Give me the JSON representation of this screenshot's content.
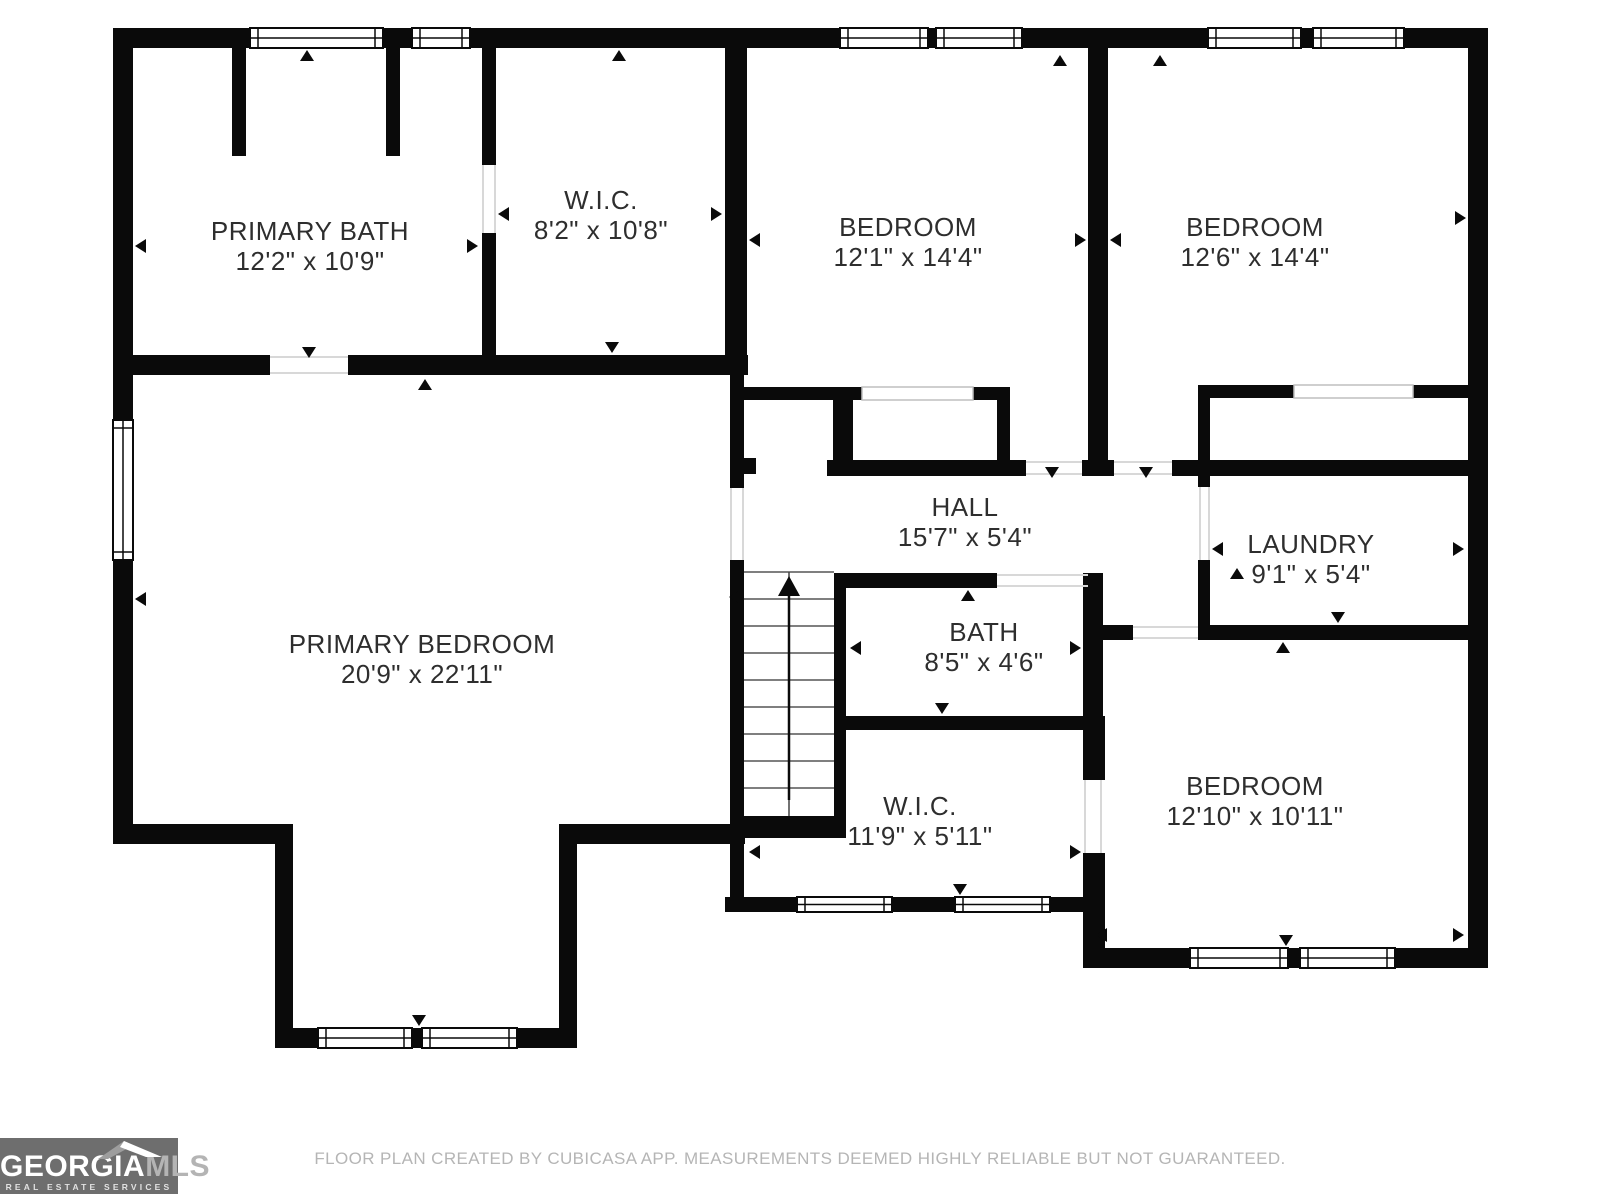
{
  "title": "Second floor plan",
  "footer": {
    "disclaimer": "FLOOR PLAN CREATED BY CUBICASA APP. MEASUREMENTS DEEMED HIGHLY RELIABLE BUT NOT GUARANTEED."
  },
  "logo": {
    "brand_primary": "GEORGIA",
    "brand_secondary": "MLS",
    "tagline": "REAL ESTATE SERVICES",
    "bg_color": "#6e6e6e",
    "primary_color": "#ffffff",
    "secondary_color": "#b4b4b4"
  },
  "rooms": [
    {
      "id": "primary-bath",
      "name": "PRIMARY BATH",
      "dims": "12'2\" x 10'9\"",
      "cx": 310,
      "name_y": 240,
      "dims_y": 270
    },
    {
      "id": "wic-top",
      "name": "W.I.C.",
      "dims": "8'2\" x 10'8\"",
      "cx": 601,
      "name_y": 209,
      "dims_y": 239
    },
    {
      "id": "bedroom-1",
      "name": "BEDROOM",
      "dims": "12'1\" x 14'4\"",
      "cx": 908,
      "name_y": 236,
      "dims_y": 266
    },
    {
      "id": "bedroom-2",
      "name": "BEDROOM",
      "dims": "12'6\" x 14'4\"",
      "cx": 1255,
      "name_y": 236,
      "dims_y": 266
    },
    {
      "id": "hall",
      "name": "HALL",
      "dims": "15'7\" x 5'4\"",
      "cx": 965,
      "name_y": 516,
      "dims_y": 546
    },
    {
      "id": "laundry",
      "name": "LAUNDRY",
      "dims": "9'1\" x 5'4\"",
      "cx": 1311,
      "name_y": 553,
      "dims_y": 583
    },
    {
      "id": "bath",
      "name": "BATH",
      "dims": "8'5\" x 4'6\"",
      "cx": 984,
      "name_y": 641,
      "dims_y": 671
    },
    {
      "id": "wic-bottom",
      "name": "W.I.C.",
      "dims": "11'9\" x 5'11\"",
      "cx": 920,
      "name_y": 815,
      "dims_y": 845
    },
    {
      "id": "primary-bedroom",
      "name": "PRIMARY BEDROOM",
      "dims": "20'9\" x 22'11\"",
      "cx": 422,
      "name_y": 653,
      "dims_y": 683
    },
    {
      "id": "bedroom-3",
      "name": "BEDROOM",
      "dims": "12'10\" x 10'11\"",
      "cx": 1255,
      "name_y": 795,
      "dims_y": 825
    }
  ],
  "floorplan": {
    "canvas": {
      "width": 1600,
      "height": 1200,
      "wall_color": "#0a0a0a",
      "bg_color": "#ffffff",
      "label_color": "#2e2e2e",
      "label_size": 26,
      "marker_color": "#0a0a0a",
      "threshold_color": "#d8d8d8",
      "stair_line_color": "#555555",
      "opening_color": "#bfbfbf"
    },
    "walls": [
      [
        113,
        28,
        1375,
        20
      ],
      [
        113,
        28,
        20,
        816
      ],
      [
        113,
        824,
        180,
        20
      ],
      [
        275,
        824,
        18,
        224
      ],
      [
        275,
        1028,
        302,
        20
      ],
      [
        559,
        824,
        18,
        224
      ],
      [
        559,
        824,
        186,
        20
      ],
      [
        1468,
        28,
        20,
        940
      ],
      [
        1083,
        948,
        405,
        20
      ],
      [
        113,
        355,
        157,
        20
      ],
      [
        348,
        355,
        400,
        20
      ],
      [
        232,
        48,
        14,
        108
      ],
      [
        386,
        48,
        14,
        108
      ],
      [
        482,
        48,
        14,
        117
      ],
      [
        482,
        233,
        14,
        122
      ],
      [
        725,
        28,
        22,
        340
      ],
      [
        730,
        368,
        14,
        120
      ],
      [
        730,
        560,
        14,
        337
      ],
      [
        744,
        458,
        12,
        16
      ],
      [
        738,
        387,
        124,
        13
      ],
      [
        973,
        387,
        37,
        13
      ],
      [
        833,
        398,
        20,
        62
      ],
      [
        997,
        387,
        13,
        85
      ],
      [
        827,
        460,
        183,
        16
      ],
      [
        1008,
        460,
        18,
        16
      ],
      [
        1082,
        460,
        32,
        16
      ],
      [
        1172,
        460,
        296,
        16
      ],
      [
        1088,
        48,
        20,
        412
      ],
      [
        1198,
        385,
        96,
        13
      ],
      [
        1413,
        385,
        55,
        13
      ],
      [
        1198,
        385,
        12,
        102
      ],
      [
        1198,
        560,
        12,
        80
      ],
      [
        1198,
        625,
        270,
        15
      ],
      [
        1103,
        625,
        30,
        15
      ],
      [
        846,
        573,
        151,
        15
      ],
      [
        1083,
        573,
        20,
        143
      ],
      [
        1083,
        716,
        22,
        64
      ],
      [
        1083,
        853,
        22,
        115
      ],
      [
        846,
        716,
        257,
        14
      ],
      [
        834,
        573,
        12,
        243
      ],
      [
        744,
        816,
        102,
        22
      ],
      [
        725,
        897,
        72,
        15
      ],
      [
        892,
        897,
        63,
        15
      ],
      [
        1050,
        897,
        45,
        15
      ]
    ],
    "windows": [
      [
        250,
        28,
        133,
        20
      ],
      [
        412,
        28,
        58,
        20
      ],
      [
        840,
        28,
        88,
        20
      ],
      [
        936,
        28,
        86,
        20
      ],
      [
        1208,
        28,
        93,
        20
      ],
      [
        1313,
        28,
        91,
        20
      ],
      [
        113,
        420,
        20,
        140
      ],
      [
        318,
        1028,
        94,
        20
      ],
      [
        422,
        1028,
        95,
        20
      ],
      [
        797,
        897,
        95,
        15
      ],
      [
        955,
        897,
        95,
        15
      ],
      [
        1190,
        948,
        98,
        20
      ],
      [
        1300,
        948,
        95,
        20
      ]
    ],
    "cased_openings": [
      [
        862,
        387,
        111,
        13
      ],
      [
        1294,
        385,
        119,
        13
      ]
    ],
    "thresholds": [
      [
        270,
        357,
        348,
        357
      ],
      [
        270,
        373,
        348,
        373
      ],
      [
        731,
        488,
        731,
        560
      ],
      [
        743,
        488,
        743,
        560
      ],
      [
        483,
        165,
        483,
        233
      ],
      [
        495,
        165,
        495,
        233
      ],
      [
        1026,
        462,
        1082,
        462
      ],
      [
        1026,
        474,
        1082,
        474
      ],
      [
        1114,
        462,
        1172,
        462
      ],
      [
        1114,
        474,
        1172,
        474
      ],
      [
        1200,
        487,
        1200,
        560
      ],
      [
        1209,
        487,
        1209,
        560
      ],
      [
        1085,
        780,
        1085,
        853
      ],
      [
        1101,
        780,
        1101,
        853
      ],
      [
        997,
        575,
        1088,
        575
      ],
      [
        997,
        586,
        1088,
        586
      ],
      [
        1133,
        627,
        1198,
        627
      ],
      [
        1133,
        638,
        1198,
        638
      ]
    ],
    "markers": [
      [
        307,
        50,
        "up"
      ],
      [
        619,
        50,
        "up"
      ],
      [
        1060,
        55,
        "up"
      ],
      [
        1160,
        55,
        "up"
      ],
      [
        309,
        358,
        "down"
      ],
      [
        612,
        353,
        "down"
      ],
      [
        135,
        246,
        "left"
      ],
      [
        478,
        246,
        "right"
      ],
      [
        498,
        214,
        "left"
      ],
      [
        722,
        214,
        "right"
      ],
      [
        749,
        240,
        "left"
      ],
      [
        1086,
        240,
        "right"
      ],
      [
        1110,
        240,
        "left"
      ],
      [
        1466,
        218,
        "right"
      ],
      [
        1052,
        478,
        "down"
      ],
      [
        1146,
        478,
        "down"
      ],
      [
        1212,
        549,
        "left"
      ],
      [
        1464,
        549,
        "right"
      ],
      [
        1237,
        568,
        "up"
      ],
      [
        1338,
        623,
        "down"
      ],
      [
        968,
        590,
        "up"
      ],
      [
        850,
        648,
        "left"
      ],
      [
        1081,
        648,
        "right"
      ],
      [
        942,
        714,
        "down"
      ],
      [
        749,
        852,
        "left"
      ],
      [
        1081,
        852,
        "right"
      ],
      [
        960,
        895,
        "down"
      ],
      [
        1283,
        642,
        "up"
      ],
      [
        1286,
        946,
        "down"
      ],
      [
        1096,
        935,
        "left"
      ],
      [
        1464,
        935,
        "right"
      ],
      [
        419,
        1026,
        "down"
      ],
      [
        425,
        379,
        "up"
      ],
      [
        135,
        599,
        "left"
      ],
      [
        729,
        597,
        "left"
      ]
    ],
    "stairs": {
      "x1": 744,
      "x2": 834,
      "top": 572,
      "bottom": 816,
      "treads": [
        599,
        626,
        653,
        680,
        707,
        734,
        761,
        788
      ],
      "center_x": 789,
      "arrow": {
        "tip_y": 576,
        "head_base_y": 596,
        "half_width": 11,
        "shaft_bottom_y": 800
      }
    }
  }
}
